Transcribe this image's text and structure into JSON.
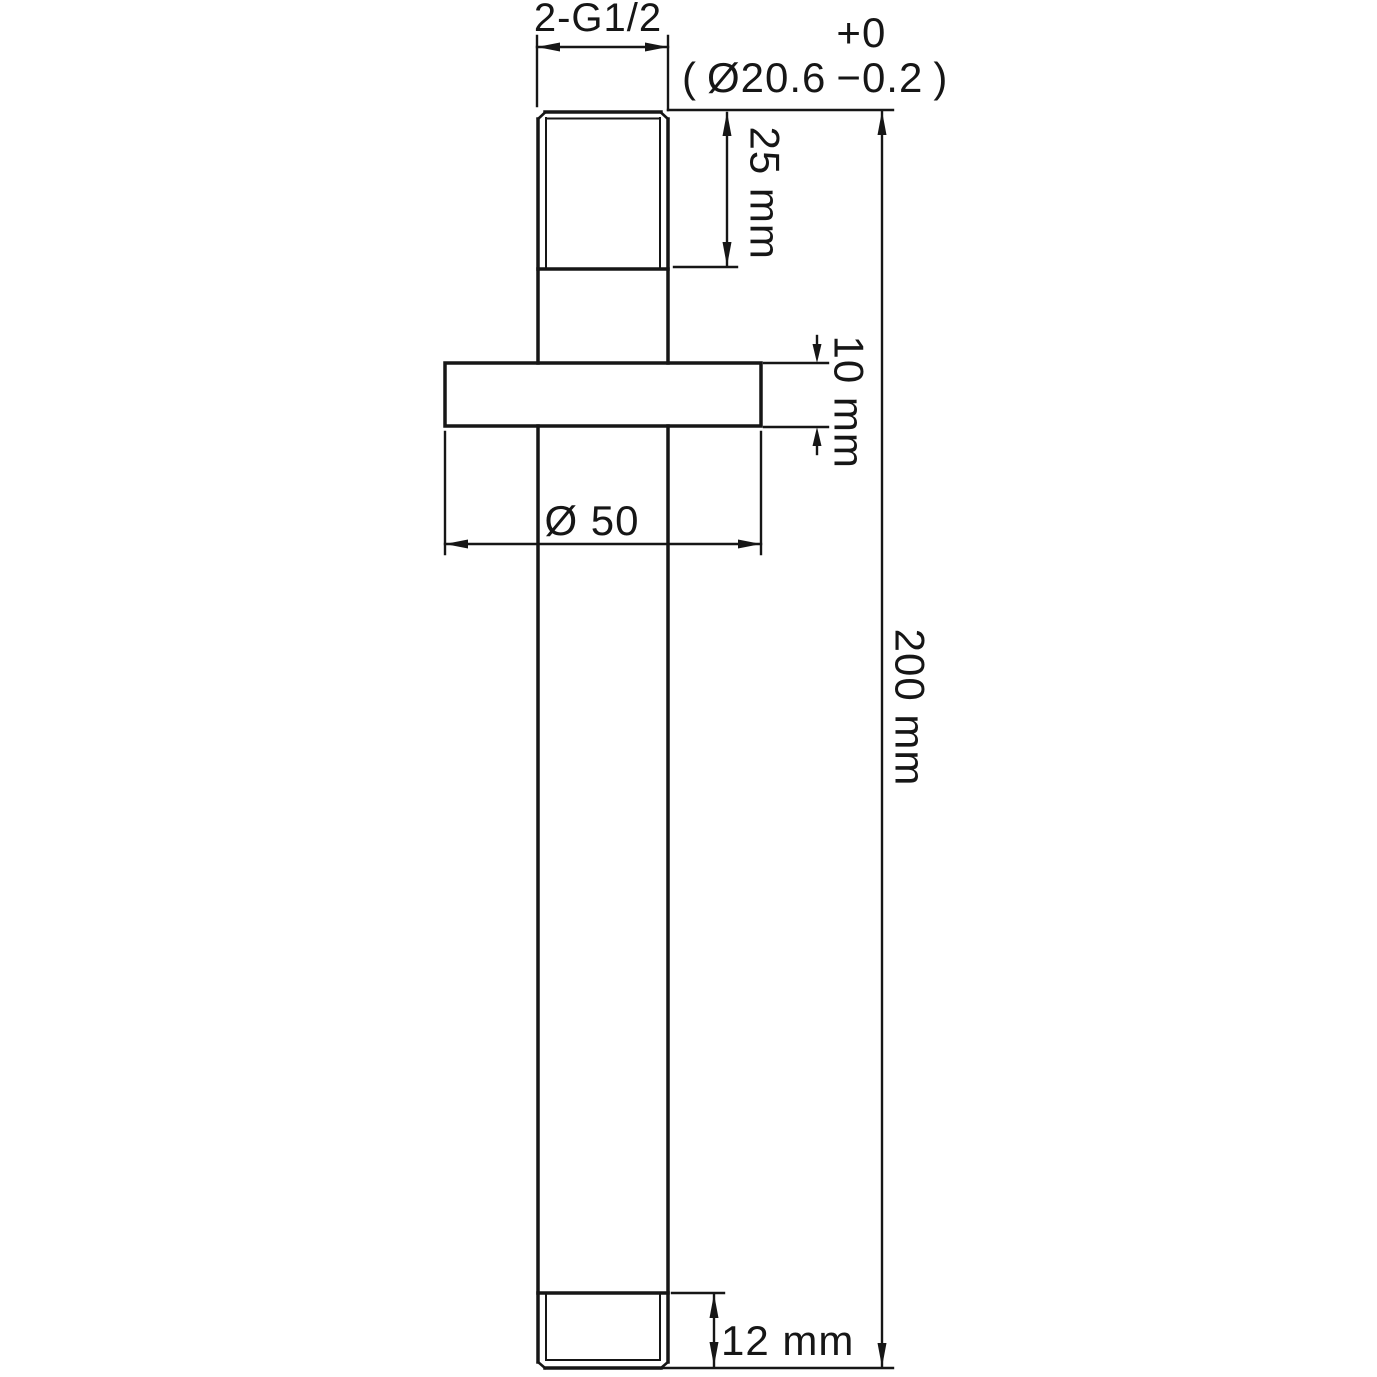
{
  "drawing": {
    "type": "technical-dimension-drawing",
    "subject": "threaded pipe arm with wall flange, front elevation",
    "colors": {
      "line": "#161616",
      "background": "#ffffff"
    }
  },
  "labels": {
    "thread_spec": "2-G1/2",
    "diameter_note": {
      "open": "(",
      "value": "Ø20.6",
      "tolerance_upper": "+0",
      "tolerance_lower": "−0.2",
      "close": ")"
    },
    "top_thread_length": "25 mm",
    "flange_thickness": "10 mm",
    "flange_diameter": "Ø 50",
    "overall_length": "200 mm",
    "bottom_thread_length": "12 mm"
  }
}
